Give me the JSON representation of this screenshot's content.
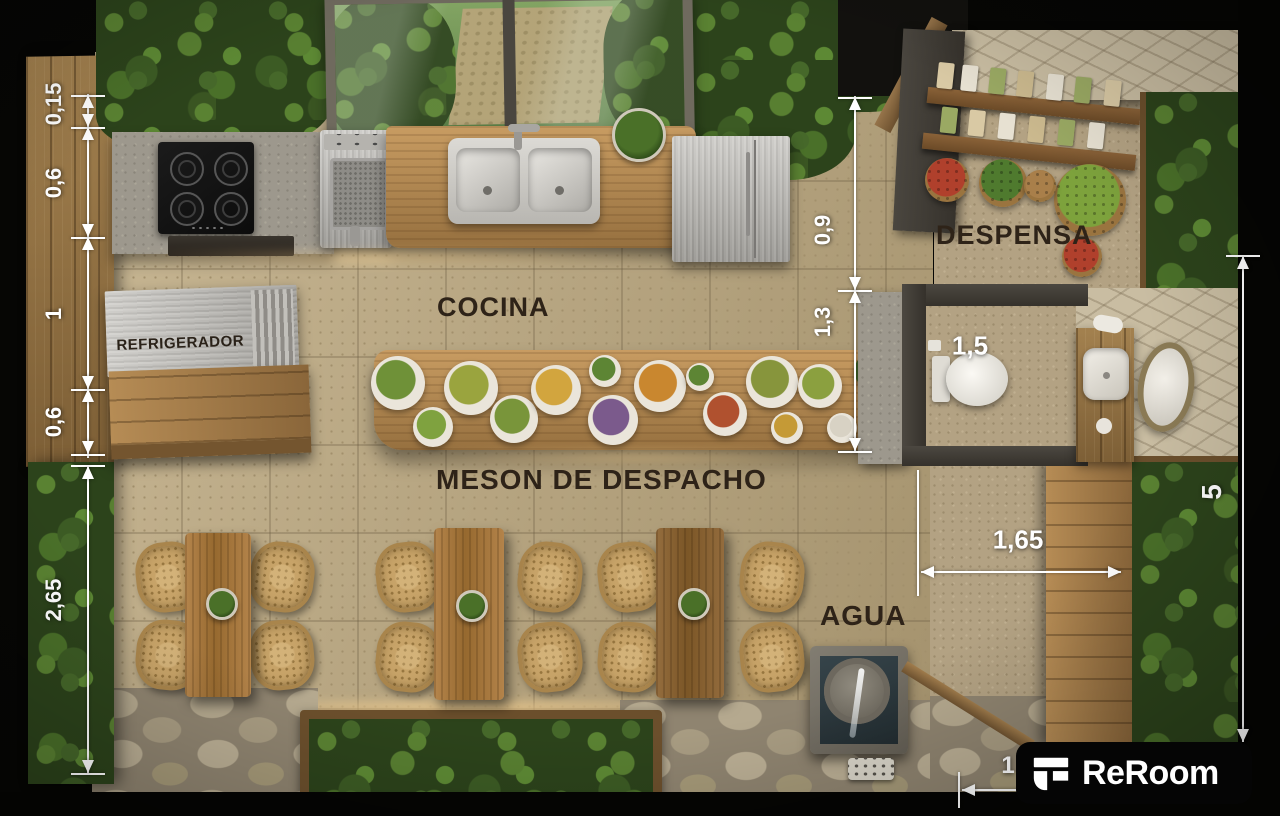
{
  "plan": {
    "labels": {
      "cocina": "COCINA",
      "meson": "MESON DE DESPACHO",
      "despensa": "DESPENSA",
      "agua": "AGUA",
      "refrigerador": "REFRIGERADOR"
    },
    "dimensions": {
      "left_chain": [
        "0,15",
        "0,6",
        "1",
        "0,6"
      ],
      "left_lower": "2,65",
      "mid_upper": "0,9",
      "mid_lower": "1,3",
      "bath_width": "1,5",
      "corridor_width": "1,65",
      "right_height": "5",
      "bottom_partial": "1"
    },
    "logo": {
      "text": "ReRoom"
    },
    "colors": {
      "dimension": "#ffffff",
      "room_label": "#2e2318",
      "logo_bg": "#050505",
      "logo_fg": "#ffffff",
      "moss": "#3c5b24",
      "wood": "#a3814f",
      "floor": "#b9a987"
    }
  },
  "decor": {
    "plates": [
      {
        "x": 398,
        "y": 383,
        "r": 27,
        "c": "#6f9138"
      },
      {
        "x": 433,
        "y": 427,
        "r": 20,
        "c": "#7fa23f"
      },
      {
        "x": 471,
        "y": 388,
        "r": 27,
        "c": "#9aa43e"
      },
      {
        "x": 514,
        "y": 419,
        "r": 24,
        "c": "#79953a"
      },
      {
        "x": 556,
        "y": 390,
        "r": 25,
        "c": "#d2a53e"
      },
      {
        "x": 605,
        "y": 371,
        "r": 16,
        "c": "#5d8534"
      },
      {
        "x": 613,
        "y": 420,
        "r": 25,
        "c": "#7b5a8c"
      },
      {
        "x": 660,
        "y": 386,
        "r": 26,
        "c": "#c9872f"
      },
      {
        "x": 700,
        "y": 377,
        "r": 14,
        "c": "#5d8534"
      },
      {
        "x": 725,
        "y": 414,
        "r": 22,
        "c": "#b0512f"
      },
      {
        "x": 772,
        "y": 382,
        "r": 26,
        "c": "#87953c"
      },
      {
        "x": 787,
        "y": 428,
        "r": 16,
        "c": "#c59a36"
      },
      {
        "x": 820,
        "y": 386,
        "r": 22,
        "c": "#8ba03f"
      },
      {
        "x": 842,
        "y": 428,
        "r": 15,
        "c": "#d8d2c4"
      },
      {
        "x": 871,
        "y": 371,
        "r": 17,
        "c": "#3f6126",
        "t": "plant"
      },
      {
        "x": 881,
        "y": 418,
        "r": 15,
        "c": "#3f6126",
        "t": "plant"
      }
    ],
    "baskets": [
      {
        "x": 947,
        "y": 180,
        "r": 22,
        "c": "#b0402c"
      },
      {
        "x": 1003,
        "y": 183,
        "r": 24,
        "c": "#4f7a2e"
      },
      {
        "x": 1090,
        "y": 200,
        "r": 36,
        "c": "#7da23c"
      },
      {
        "x": 1082,
        "y": 257,
        "r": 20,
        "c": "#b0402c"
      },
      {
        "x": 1040,
        "y": 186,
        "r": 16,
        "c": "#a97f4a"
      }
    ]
  }
}
